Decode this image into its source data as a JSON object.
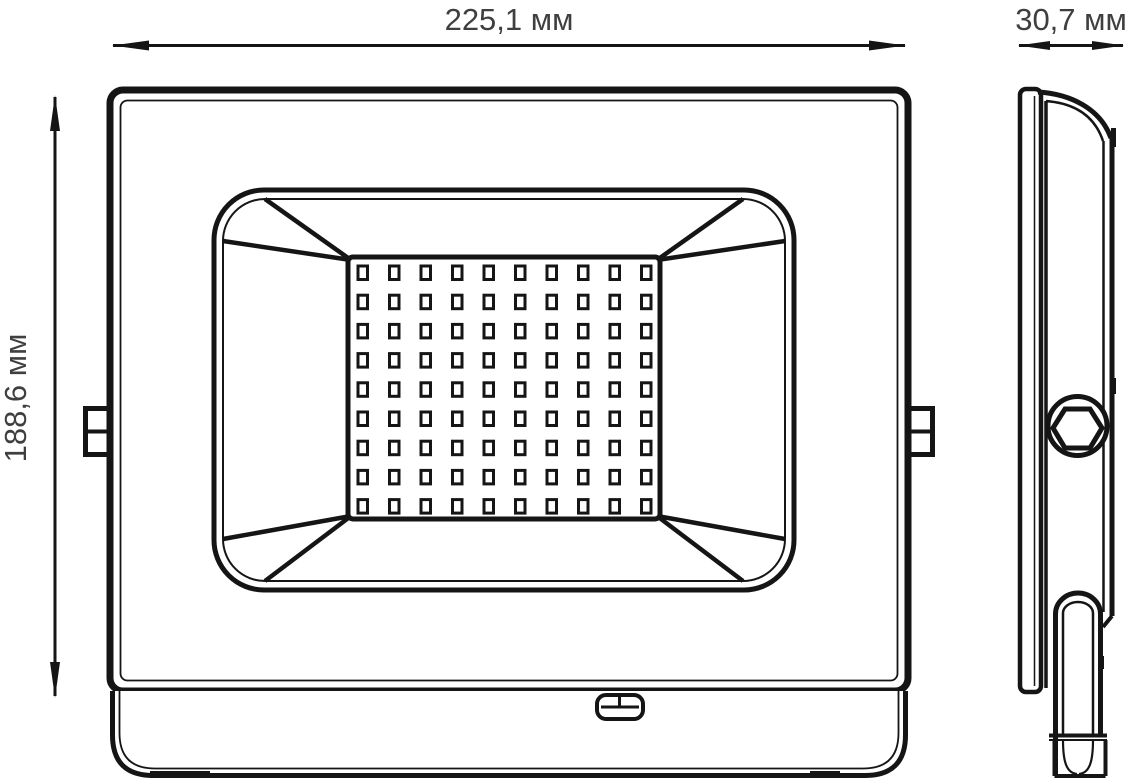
{
  "colors": {
    "line": "#151515",
    "dimension_text": "#3f3f3f",
    "background": "#ffffff"
  },
  "drawing": {
    "type": "technical-dimension-drawing",
    "subject": "LED floodlight, front and side orthographic views",
    "views": {
      "front": {
        "width_label": "225,1 мм",
        "height_label": "188,6 мм",
        "led_grid": {
          "columns": 10,
          "rows": 9
        }
      },
      "side": {
        "depth_label": "30,7 мм"
      }
    }
  }
}
